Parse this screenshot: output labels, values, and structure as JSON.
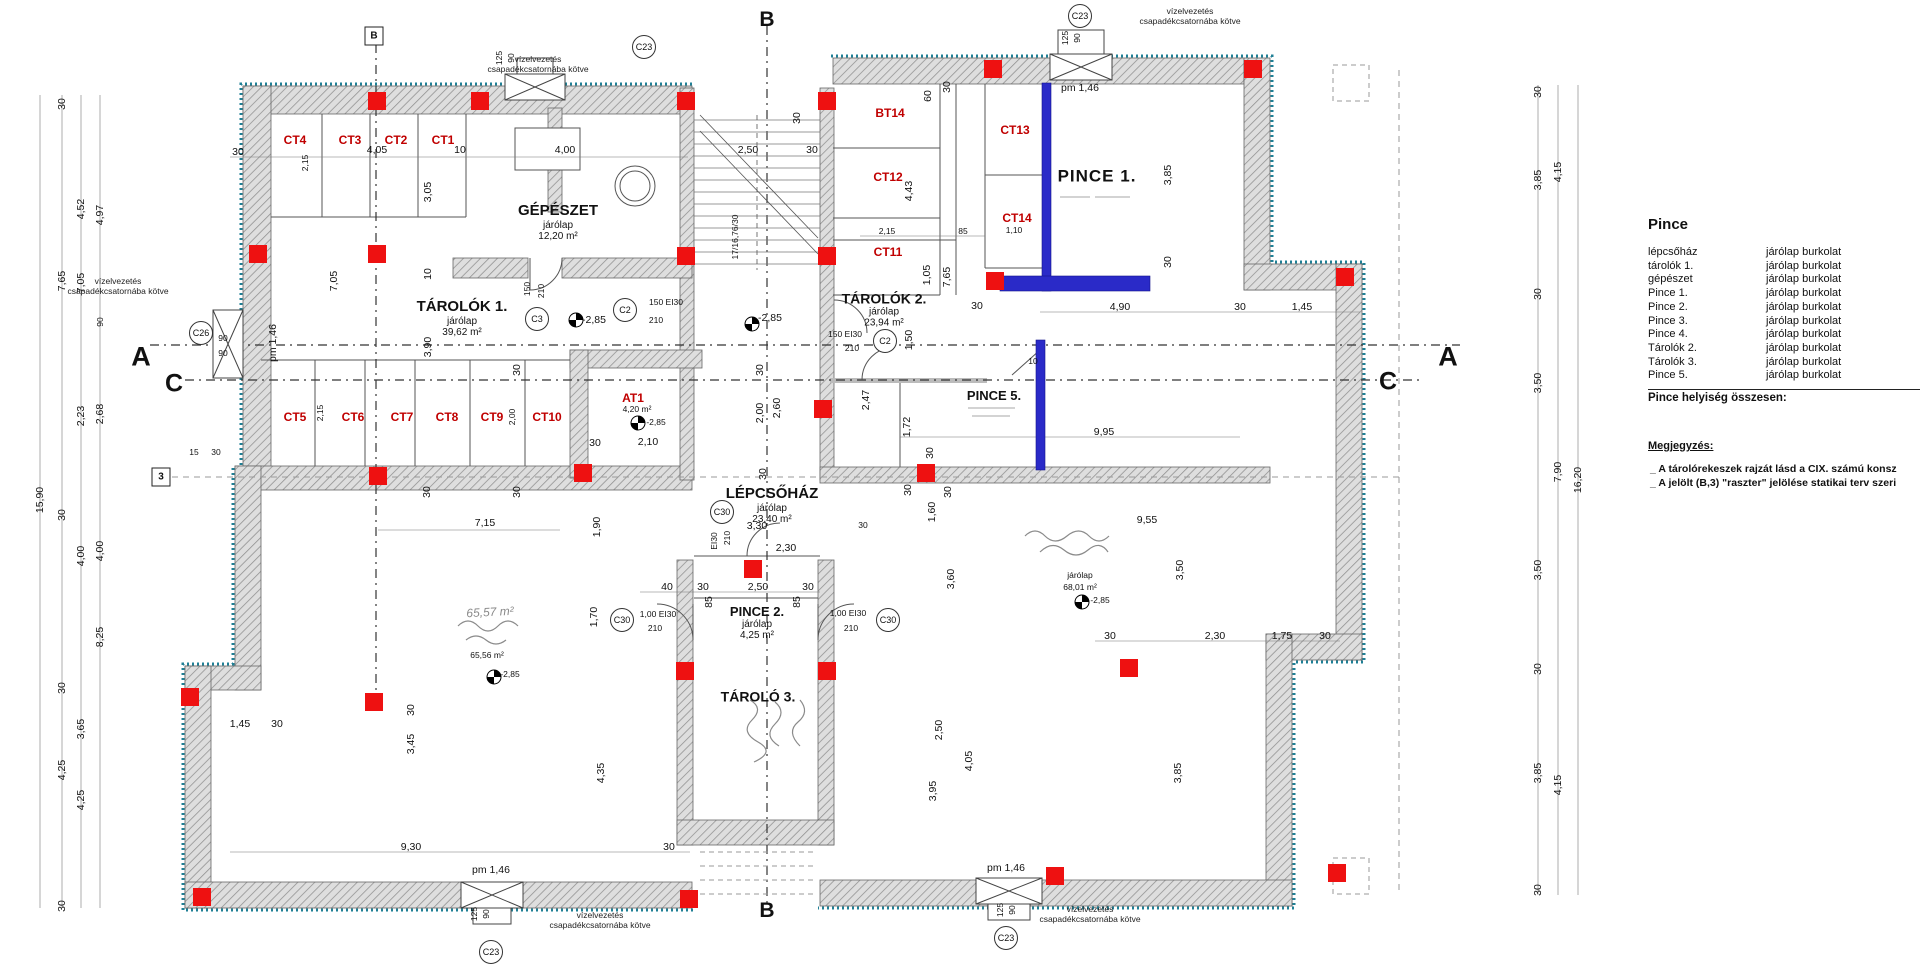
{
  "title": "Pince alaprajz (basement floor plan)",
  "legend": {
    "title": "Pince",
    "rows": [
      {
        "name": "lépcsőház",
        "finish": "járólap burkolat"
      },
      {
        "name": "tárolók 1.",
        "finish": "járólap burkolat"
      },
      {
        "name": "gépészet",
        "finish": "járólap burkolat"
      },
      {
        "name": "Pince 1.",
        "finish": "járólap burkolat"
      },
      {
        "name": "Pince 2.",
        "finish": "járólap burkolat"
      },
      {
        "name": "Pince 3.",
        "finish": "járólap burkolat"
      },
      {
        "name": "Pince 4.",
        "finish": "járólap burkolat"
      },
      {
        "name": "Tárolók 2.",
        "finish": "járólap burkolat"
      },
      {
        "name": "Tárolók 3.",
        "finish": "járólap burkolat"
      },
      {
        "name": "Pince 5.",
        "finish": "járólap burkolat"
      }
    ],
    "total_label": "Pince helyiség összesen:",
    "notes_title": "Megjegyzés:",
    "notes": [
      "_ A tárolórekeszek rajzát lásd a CIX. számú konsz",
      "_ A jelölt (B,3) \"raszter\" jelölése statikai terv szeri"
    ]
  },
  "rooms": {
    "gepeszet": {
      "name": "GÉPÉSZET",
      "finish": "járólap",
      "area": "12,20 m²"
    },
    "tarolok1": {
      "name": "TÁROLÓK 1.",
      "finish": "járólap",
      "area": "39,62 m²"
    },
    "lepcsohaz": {
      "name": "LÉPCSŐHÁZ",
      "finish": "járólap",
      "area": "23,40 m²"
    },
    "pince2": {
      "name": "PINCE 2.",
      "finish": "járólap",
      "area": "4,25 m²"
    },
    "tarolo3": {
      "name": "TÁROLÓ 3."
    },
    "tarolok2": {
      "name": "TÁROLÓK 2.",
      "finish": "járólap",
      "area": "23,94 m²"
    },
    "pince1": {
      "name": "PINCE 1."
    },
    "pince5": {
      "name": "PINCE 5."
    },
    "room_left": {
      "area_sketch": "65,57 m²",
      "area": "65,56 m²",
      "level": "-2,85"
    },
    "room_right": {
      "finish": "járólap",
      "area": "68,01 m²",
      "level": "-2,85"
    }
  },
  "cells": {
    "ct1": "CT1",
    "ct2": "CT2",
    "ct3": "CT3",
    "ct4": "CT4",
    "ct5": "CT5",
    "ct6": "CT6",
    "ct7": "CT7",
    "ct8": "CT8",
    "ct9": "CT9",
    "ct10": "CT10",
    "ct11": "CT11",
    "ct12": "CT12",
    "ct13": "CT13",
    "ct14": "CT14",
    "bt14": "BT14",
    "at1": "AT1"
  },
  "markers": {
    "a": "A",
    "b": "B",
    "c": "C",
    "axis3": "3",
    "c23": "C23",
    "c3": "C3",
    "c2": "C2",
    "c30": "C30",
    "c26": "C26"
  },
  "annotations": {
    "drain1": "vízelvezetés",
    "drain2": "csapadékcsatornába kötve"
  },
  "colors": {
    "marker_red": "#ee1111",
    "highlight_blue": "#2a2ac8",
    "insulation_teal": "#1f7f95",
    "label_red": "#c00000"
  },
  "dims": {
    "items": [
      "4,05",
      "30",
      "10",
      "4,00",
      "3,05",
      "2,15",
      "7,05",
      "10",
      "3,90",
      "30",
      "150",
      "210",
      "-2,85",
      "2,50",
      "30",
      "30",
      "60",
      "30",
      "17/16,76/30",
      "2,15",
      "85",
      "4,43",
      "1,05",
      "7,65",
      "pm 1,46",
      "3,85",
      "30",
      "4,90",
      "30",
      "1,45",
      "150 EI30",
      "210",
      "1,50",
      "-2,85",
      "30",
      "30",
      "10",
      "2,47",
      "1,72",
      "9,95",
      "30",
      "30",
      "30",
      "1,60",
      "30",
      "9,55",
      "3,50",
      "3,60",
      "2,50",
      "4,05",
      "3,95",
      "3,85",
      "30",
      "2,30",
      "1,75",
      "30",
      "2,00",
      "2,60",
      "30",
      "2,10",
      "30",
      "150 EI30",
      "210",
      "1,90",
      "7,15",
      "30",
      "30",
      "3,30",
      "2,30",
      "EI30",
      "210",
      "40",
      "30",
      "2,50",
      "30",
      "85",
      "85",
      "1,00 EI30",
      "210",
      "1,00 EI30",
      "210",
      "1,70",
      "1,45",
      "30",
      "30",
      "3,45",
      "4,35",
      "9,30",
      "30",
      "pm 1,46",
      "125",
      "90",
      "pm 1,46",
      "125",
      "90",
      "90",
      "90",
      "pm 1,46",
      "15",
      "30",
      "2,15",
      "2,00",
      "1,10",
      "4,20 m²",
      "-2,85",
      "125",
      "90",
      "125",
      "90",
      "15,90",
      "30",
      "7,65",
      "30",
      "30",
      "4,25",
      "30",
      "4,52",
      "7,05",
      "2,23",
      "4,00",
      "3,65",
      "4,25",
      "4,97",
      "90",
      "2,68",
      "4,00",
      "8,25",
      "30",
      "3,85",
      "30",
      "3,50",
      "3,50",
      "30",
      "3,85",
      "30",
      "4,15",
      "7,90",
      "4,15",
      "16,20",
      "65,56 m²",
      "-2,85",
      "járólap",
      "68,01 m²",
      "-2,85"
    ]
  }
}
